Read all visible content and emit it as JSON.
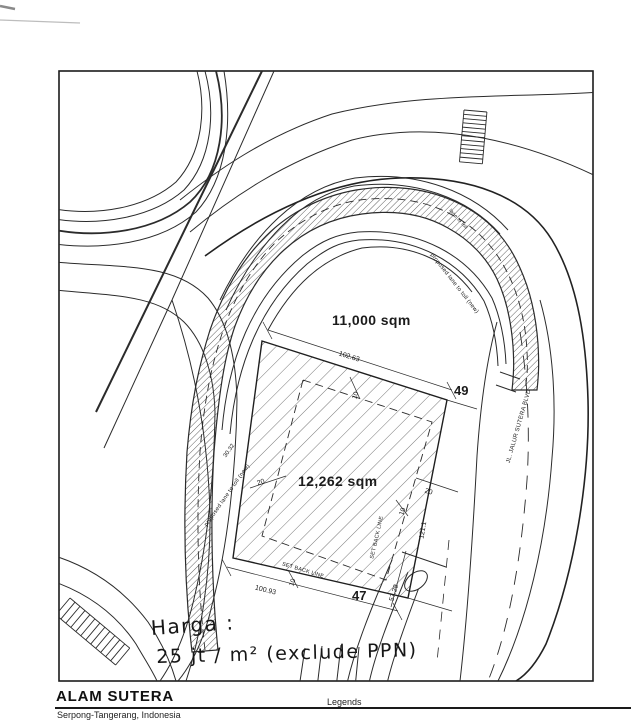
{
  "drawing": {
    "areas": {
      "upper": "11,000 sqm",
      "lower": "12,262 sqm"
    },
    "plot_numbers": {
      "upper": "49",
      "lower": "47"
    },
    "dimensions": {
      "top": "102.63",
      "bottom": "100.93",
      "right_lower": "57.28",
      "right_side": "121.1",
      "offset_top": "10",
      "offset_left": "20",
      "offset_right": "20",
      "offset_right_small": "10",
      "offset_bottom": "10",
      "band_width": "30.32"
    },
    "setback": {
      "bottom": "SET BACK LINE",
      "right": "SET BACK LINE"
    },
    "roads": {
      "main": "JL. JALUR SUTERA BLVD",
      "proposed_right": "proposed lane to toll (new)",
      "proposed_left": "proposed lane to toll (new)",
      "proposed_outer": "lane to toll"
    }
  },
  "handwriting": {
    "line1": "Harga :",
    "line2": "25 jt / m²  (exclude PPN)"
  },
  "footer": {
    "title": "ALAM SUTERA",
    "subtitle": "Serpong-Tangerang, Indonesia",
    "legends": "Legends"
  }
}
